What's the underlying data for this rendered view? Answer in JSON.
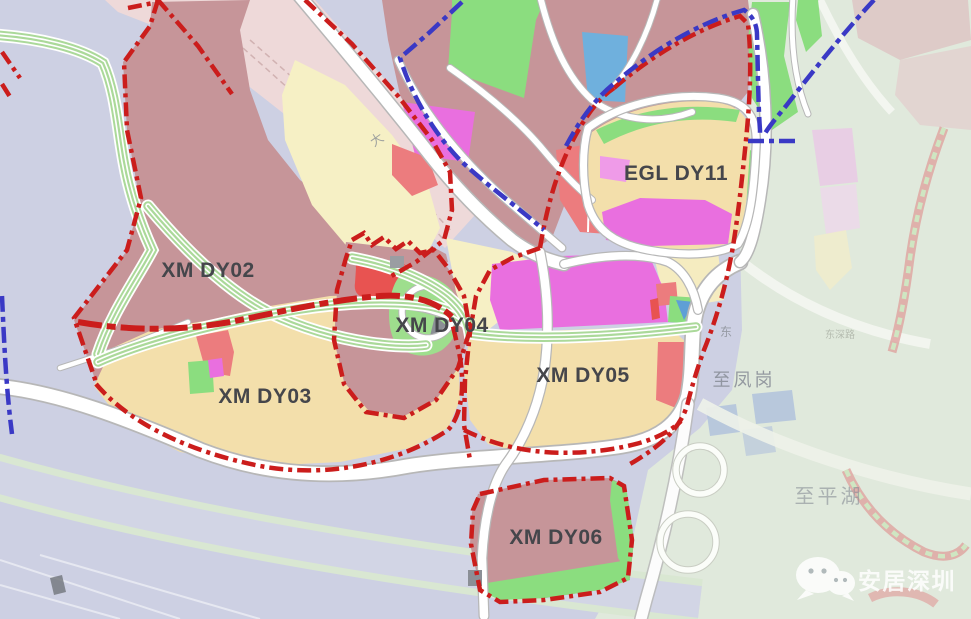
{
  "map": {
    "districts": [
      {
        "id": "xm-dy02",
        "label": "XM DY02"
      },
      {
        "id": "xm-dy03",
        "label": "XM DY03"
      },
      {
        "id": "xm-dy04",
        "label": "XM DY04"
      },
      {
        "id": "xm-dy05",
        "label": "XM DY05"
      },
      {
        "id": "xm-dy06",
        "label": "XM DY06"
      },
      {
        "id": "egl-dy11",
        "label": "EGL DY11"
      }
    ],
    "place_labels": [
      {
        "id": "to-fenggang",
        "text": "至凤岗"
      },
      {
        "id": "to-pinghu",
        "text": "至平湖"
      }
    ],
    "road_labels": [
      {
        "id": "road-char-da",
        "text": "大"
      },
      {
        "id": "road-char-dong",
        "text": "东"
      },
      {
        "id": "road-dongshen",
        "text": "东深路"
      }
    ],
    "watermark": {
      "text": "安居深圳"
    },
    "colors": {
      "red_unit_boundary": "#cb1d1c",
      "blue_planning_boundary": "#3a39c5",
      "residential_parcel": "#c69599",
      "village_parcel": "#f3dfab",
      "commercial_parcel": "#e96fdf",
      "green_space": "#8bdd7f",
      "public_parcel": "#ec7c7e",
      "red_parcel": "#e85351",
      "blue_parcel": "#6fb0dd",
      "pale_yellow_parcel": "#f6f0c5",
      "label_text": "#45464b",
      "watermark_text": "#ffffff"
    }
  }
}
